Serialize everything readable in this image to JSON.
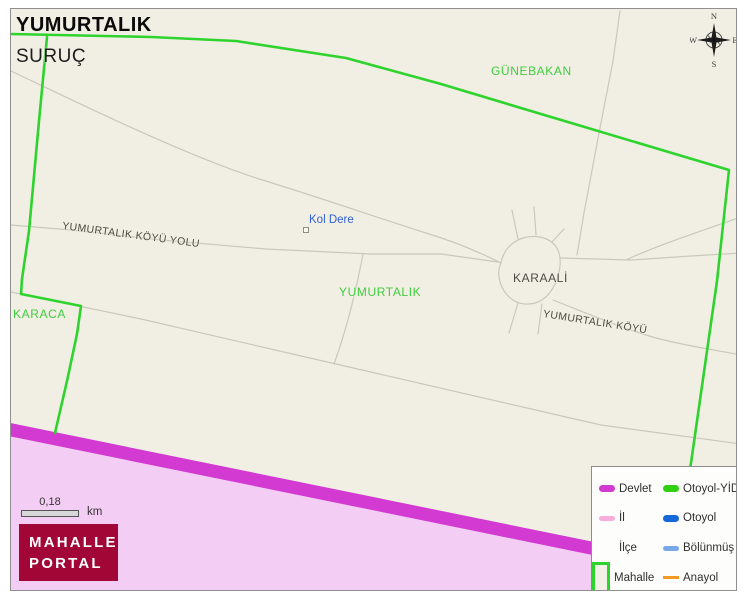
{
  "header": {
    "neighborhood": "YUMURTALIK",
    "district": "SURUÇ"
  },
  "map_labels": {
    "neighbor_top": "GÜNEBAKAN",
    "stream": "Kol Dere",
    "road_main": "YUMURTALIK KÖYÜ YOLU",
    "village": "KARAALİ",
    "neighborhood_center": "YUMURTALIK",
    "neighbor_left": "KARACA",
    "road_east": "YUMURTALIK KÖYÜ"
  },
  "compass": {
    "north": "N",
    "east": "E",
    "south": "S",
    "west": "W"
  },
  "scale_bar": {
    "distance": "0,18",
    "unit": "km"
  },
  "logo": {
    "line1": "MAHALLE",
    "line2": "PORTAL"
  },
  "legend": {
    "items": [
      {
        "label": "Devlet",
        "symbol": "thick-line",
        "color": "#d23ad2"
      },
      {
        "label": "Otoyol-YİD",
        "symbol": "thick-line",
        "color": "#30d012"
      },
      {
        "label": "İl",
        "symbol": "medium-line",
        "color": "#f6addb"
      },
      {
        "label": "Otoyol",
        "symbol": "thick-line",
        "color": "#1668d8"
      },
      {
        "label": "İlçe",
        "symbol": "none",
        "color": "#ffffff"
      },
      {
        "label": "Bölünmüş Y",
        "symbol": "medium-line",
        "color": "#77a9e8"
      },
      {
        "label": "Mahalle",
        "symbol": "box-outline",
        "color": "#2ed32e"
      },
      {
        "label": "Anayol",
        "symbol": "thin-line",
        "color": "#f49a20"
      }
    ]
  },
  "colors": {
    "map_background": "#f1efe3",
    "mahalle_boundary": "#2ed32e",
    "mahalle_label": "#40cc40",
    "road": "#c9c8bc",
    "devlet_road": "#d23ad2",
    "outside_area": "#f3cdf3",
    "stream_label": "#2f5fd0",
    "logo_background": "#a20636"
  }
}
